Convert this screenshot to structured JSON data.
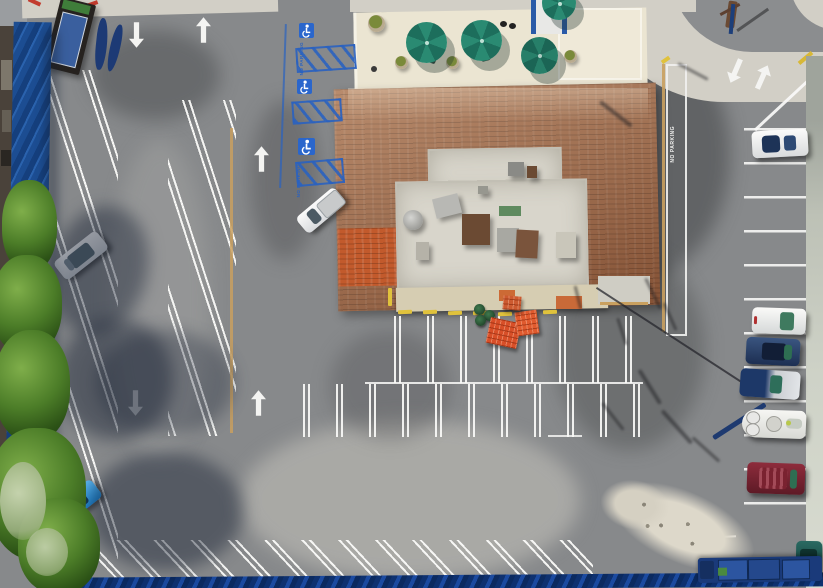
{
  "image": {
    "type": "aerial-drone-photo",
    "subject": "Top-down aerial view of a commercial parking lot with a brown-shingle-roof building, patio umbrellas, painted parking stripes and parked vehicles",
    "width_px": 823,
    "height_px": 588
  },
  "painted_text": {
    "no_parking": "NO PARKING"
  },
  "parking": {
    "handicap_symbols": 3,
    "handicap_aisle_color": "#2a62c0",
    "stripe_color": "#f2f2f0",
    "directional_arrows": [
      {
        "location": "top-left-entrance-left-lane",
        "direction": "down"
      },
      {
        "location": "top-left-entrance-right-lane",
        "direction": "up"
      },
      {
        "location": "left-lot-center",
        "direction": "up"
      },
      {
        "location": "left-lot-lower-left-lane",
        "direction": "down"
      },
      {
        "location": "left-lot-lower-right-lane",
        "direction": "up"
      },
      {
        "location": "right-entrance-left-lane",
        "direction": "down"
      },
      {
        "location": "right-entrance-right-lane",
        "direction": "up"
      }
    ],
    "curb_colors": {
      "accessible_blue": "#2a62c0",
      "no_parking_curb_tan": "#c9a05f",
      "wheel_stop_yellow": "#e0c23c",
      "red_curb": "#c23b2e"
    }
  },
  "building": {
    "roof_style": "brown shingle mansard around flat white roof",
    "roof_color": "#9d6848",
    "orange_roof_section_color": "#c25a2c",
    "flat_roof_color": "#d8d5cb",
    "rooftop_units_visible": 10,
    "patio": {
      "umbrella_count": 3,
      "umbrella_color": "#1f7a66",
      "planter_count": 4,
      "surface_color": "#ebe5d2"
    }
  },
  "vehicles": [
    {
      "type": "hatchback",
      "color": "silver-white",
      "location": "left lot angled stall"
    },
    {
      "type": "hatchback",
      "color": "bright blue",
      "location": "left lot lower angled stall"
    },
    {
      "type": "pickup-truck",
      "color": "white",
      "location": "angled stall beside building"
    },
    {
      "type": "convertible",
      "color": "white with navy top",
      "location": "right row top stall"
    },
    {
      "type": "sedan",
      "color": "white",
      "location": "right row"
    },
    {
      "type": "sedan",
      "color": "dark navy",
      "location": "right row"
    },
    {
      "type": "covered-car",
      "color": "silver and navy",
      "location": "right row"
    },
    {
      "type": "boat-on-trailer",
      "color": "white",
      "location": "right row"
    },
    {
      "type": "suv",
      "color": "maroon",
      "location": "right row"
    },
    {
      "type": "car",
      "color": "dark teal",
      "location": "bottom right corner"
    },
    {
      "type": "flatbed-truck",
      "color": "blue with cargo",
      "location": "bottom edge"
    }
  ],
  "objects": {
    "orange_pallet_stacks": 3,
    "green_barrels": 3,
    "debris_pile": "light sand and rubble pile, lower right",
    "monument_sign": 1,
    "navy_banners": 2,
    "utility_pole": 1,
    "overhead_cable": 1,
    "trees_left_edge": 5
  },
  "palette": {
    "asphalt": "#87898b",
    "asphalt_dark": "#6e7072",
    "asphalt_light_patch": "#a8a7a4",
    "concrete": "#d2cfc6",
    "patio": "#ebe5d2",
    "blue_wall": "#1c4d92",
    "blue_metal_roof_bottom": "#0e3170",
    "tree_green": "#4c7d28"
  }
}
